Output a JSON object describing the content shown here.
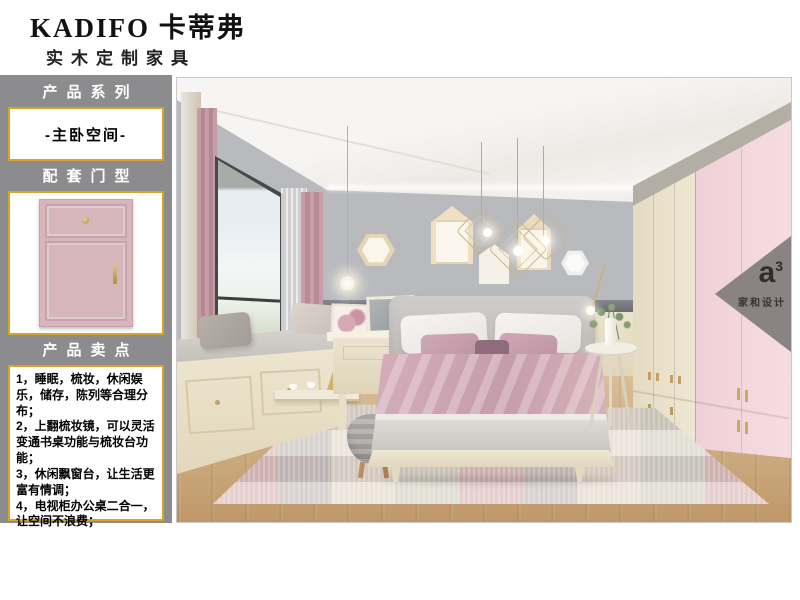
{
  "brand": {
    "name": "KADIFO 卡蒂弗",
    "tagline": "实木定制家具"
  },
  "sidebar": {
    "sections": [
      {
        "title": "产品系列"
      },
      {
        "title": "配套门型"
      },
      {
        "title": "产品卖点"
      }
    ],
    "series": "-主卧空间-",
    "selling_points": [
      "1，睡眠，梳妆，休闲娱乐，储存，陈列等合理分布；",
      "2，上翻梳妆镜，可以灵活变通书桌功能与梳妆台功能；",
      "3，休闲飘窗台，让生活更富有情调；",
      "4，电视柜办公桌二合一，让空间不浪费；"
    ]
  },
  "watermark": {
    "logo": "a",
    "logo_sup": "3",
    "studio": "家和设计"
  },
  "colors": {
    "sidebar_gray": "#8c8c8e",
    "accent_gold": "#d8a522",
    "door_pink": "#d6b5bb",
    "wall_gray": "#b9babe",
    "wardrobe_cream": "#ebe2cc",
    "wardrobe_pink": "#f4d9de"
  }
}
